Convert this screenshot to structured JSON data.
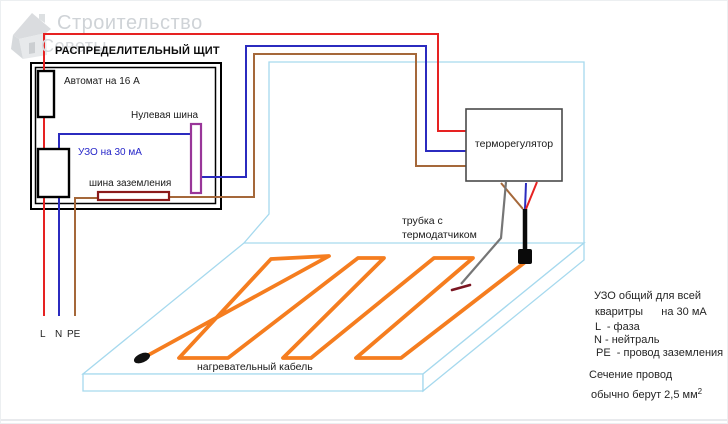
{
  "watermark": {
    "line1": "Строительство",
    "line2": "Советы"
  },
  "distribution_panel": {
    "title": "РАСПРЕДЕЛИТЕЛЬНЫЙ ЩИТ",
    "breaker_label": "Автомат на 16 А",
    "neutral_bus_label": "Нулевая шина",
    "rcd_label": "УЗО на 30 мА",
    "ground_bus_label": "шина заземления"
  },
  "thermostat": {
    "label": "терморегулятор"
  },
  "sensor": {
    "line1": "трубка с",
    "line2": "термодатчиком"
  },
  "heating_cable": {
    "label": "нагревательный кабель"
  },
  "supply_terminals": {
    "l": "L",
    "n": "N",
    "pe": "PE"
  },
  "notes": {
    "rcd_line1": "УЗО общий для всей",
    "rcd_line2": "кваритры      на 30 мА",
    "legend_l": "L  - фаза",
    "legend_n": "N - нейтраль",
    "legend_pe": "PE  - провод заземления",
    "section_line1": "Сечение провод",
    "section_line2": "обычно берут 2,5 мм",
    "section_sup": "2"
  },
  "colors": {
    "phase_wire": "#e62222",
    "neutral_wire": "#2b2bbf",
    "ground_wire": "#a5683a",
    "neutral_bus": "#993699",
    "ground_bus": "#8b1a1a",
    "heating_cable": "#f57d1f",
    "room_outline": "#a6d9ee",
    "sensor_tube": "#767676",
    "sensor_tip": "#7b1622"
  }
}
